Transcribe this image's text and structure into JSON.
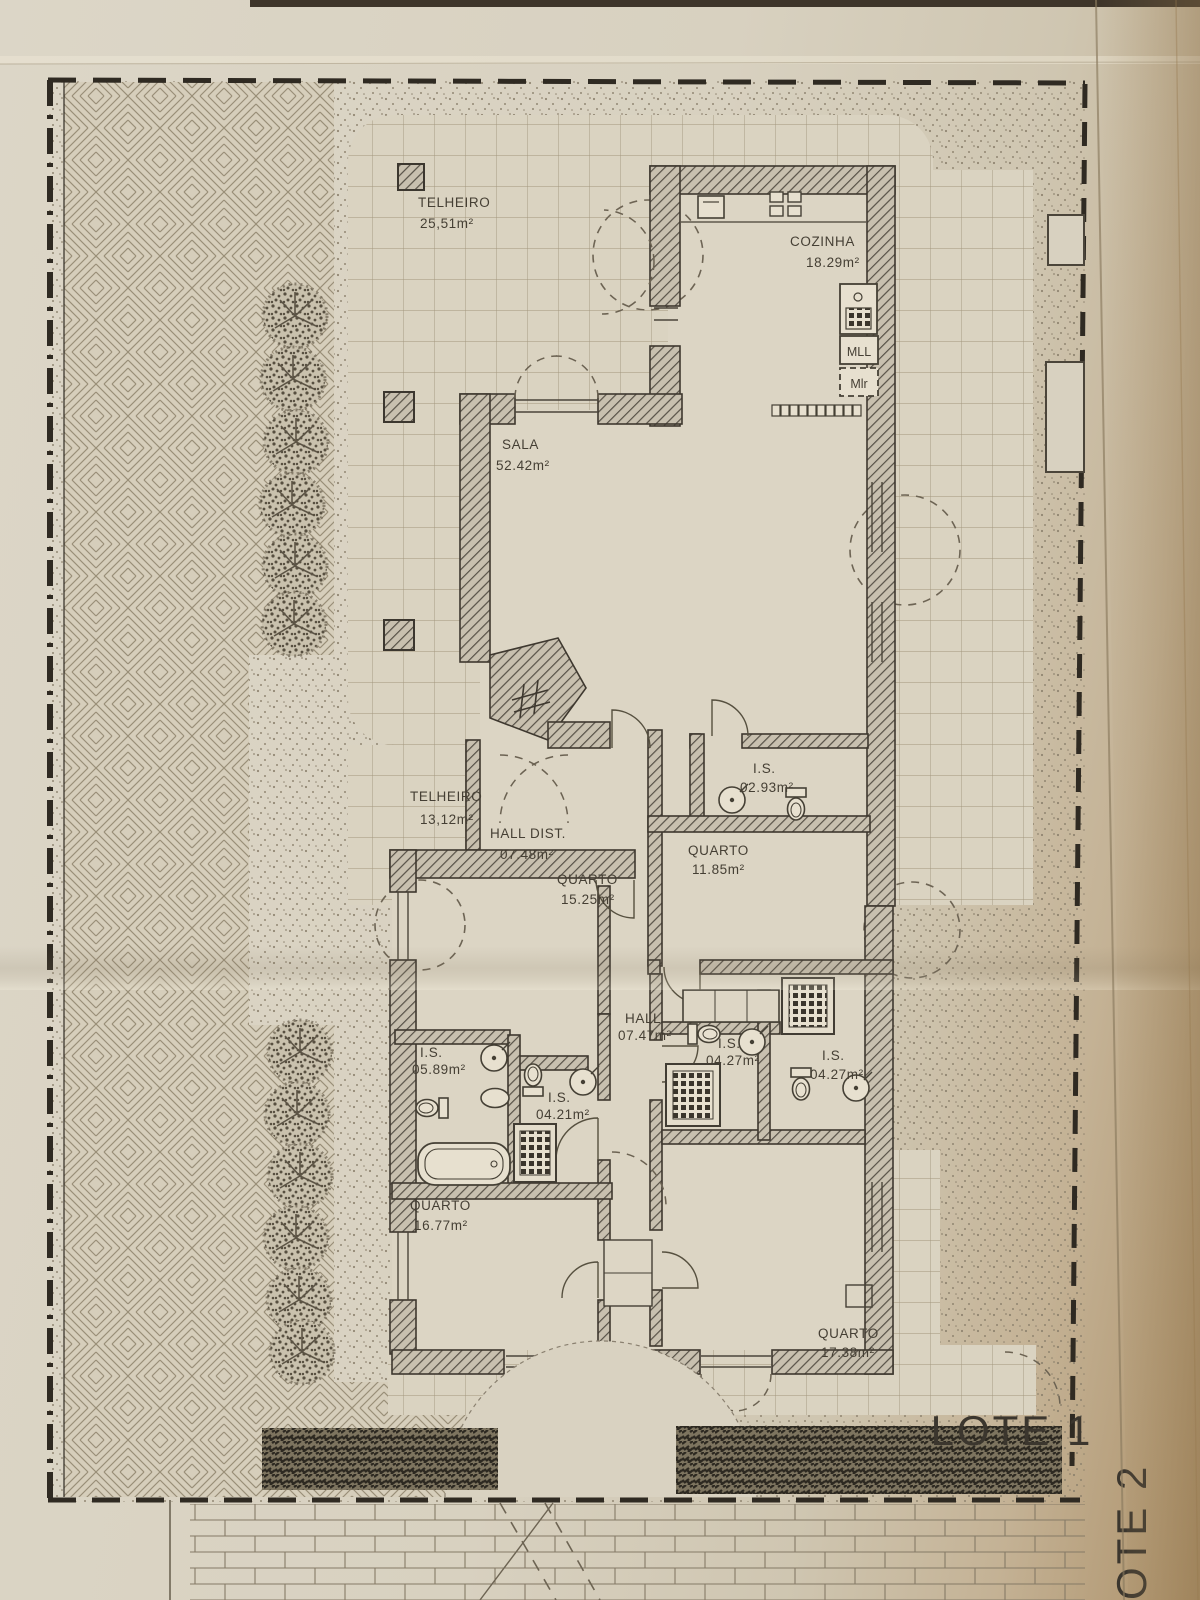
{
  "site": {
    "lot1_label": "LOTE 1",
    "lot2_label": "LOTE 2"
  },
  "rooms": [
    {
      "name": "TELHEIRO",
      "area": "25,51m²"
    },
    {
      "name": "COZINHA",
      "area": "18.29m²"
    },
    {
      "name": "SALA",
      "area": "52.42m²"
    },
    {
      "name": "TELHEIRO",
      "area": "13,12m²"
    },
    {
      "name": "HALL DIST.",
      "area": "07.48m²"
    },
    {
      "name": "QUARTO",
      "area": "15.25m²"
    },
    {
      "name": "I.S.",
      "area": "02.93m²"
    },
    {
      "name": "QUARTO",
      "area": "11.85m²"
    },
    {
      "name": "HALL",
      "area": "07.47m²"
    },
    {
      "name": "I.S.",
      "area": "05.89m²"
    },
    {
      "name": "I.S.",
      "area": "04.21m²"
    },
    {
      "name": "I.S.",
      "area": "04.27m²"
    },
    {
      "name": "I.S.",
      "area": "04.27m²"
    },
    {
      "name": "QUARTO",
      "area": "16.77m²"
    },
    {
      "name": "QUARTO",
      "area": "17.38m²"
    }
  ],
  "kitchen": {
    "dishwasher_label": "MLL",
    "washer_label": "Mlr"
  },
  "colors": {
    "paper": "#d8d1c0",
    "ink": "#453f34",
    "wall_hatch": "#575147",
    "boundary": "#2f2a22",
    "foliage": "#3a352b"
  }
}
